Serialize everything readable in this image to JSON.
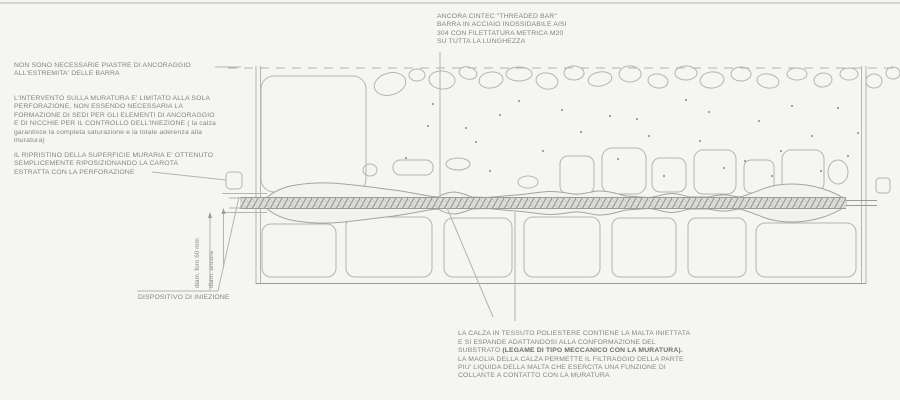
{
  "annotations": {
    "top_note": "ANCORA CINTEC \"THREADED BAR\"\nBARRA IN ACCIAIO INOSSIDABILE AISI\n304 CON FILETTATURA METRICA M20\nSU TUTTA LA LUNGHEZZA",
    "left_note_1": "NON SONO NECESSARIE PIASTRE DI ANCORAGGIO\nALL'ESTREMITA' DELLE BARRA",
    "left_note_2": "L'INTERVENTO SULLA MURATURA E' LIMITATO ALLA SOLA\nPERFORAZIONE, NON ESSENDO NECESSARIA LA\nFORMAZIONE DI SEDI PER GLI ELEMENTI DI ANCORAGGIO\nE DI NICCHIE PER IL CONTROLLO DELL'INIEZIONE ( la calza\ngarantisce la completa saturazione e la totale aderenza alla\nmuratura)",
    "left_note_3": "IL RIPRISTINO DELLA SUPERFICIE MURARIA E' OTTENUTO\nSEMPLICEMENTE RIPOSIZIONANDO LA CAROTA\nESTRATTA CON LA PERFORAZIONE",
    "injection_label": "DISPOSITIVO DI INIEZIONE",
    "bottom_note_pre": "LA CALZA IN TESSUTO POLIESTERE CONTIENE LA MALTA INIETTATA\nE SI ESPANDE ADATTANDOSI ALLA CONFORMAZIONE DEL\nSUBSTRATO ",
    "bottom_note_bold": "(LEGAME DI TIPO MECCANICO CON LA MURATURA).",
    "bottom_note_post": "\nLA MAGLIA DELLA CALZA PERMETTE IL FILTRAGGIO DELLA PARTE\nPIU' LIQUIDA DELLA MALTA CHE ESERCITA UNA FUNZIONE DI\nCOLLANTE A CONTATTO CON LA MURATURA",
    "dim_foro": "diam. foro 60 mm",
    "dim_ancora": "diam. ancora"
  },
  "colors": {
    "line": "#b4b4b4",
    "line-dark": "#9a9a9a",
    "text": "#858585",
    "hatch": "#8d8d8d",
    "bg": "#f5f5f2",
    "sock-fill": "#f2f2ef"
  }
}
